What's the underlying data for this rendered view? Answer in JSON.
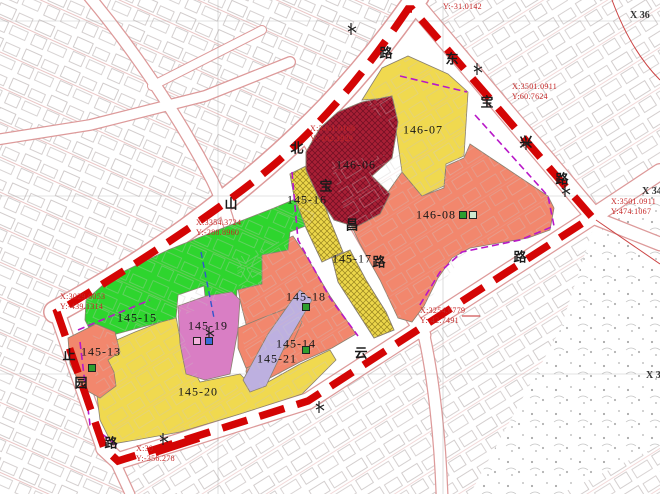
{
  "map": {
    "colors": {
      "green": "#2ed52e",
      "yellow": "#f0d94f",
      "salmon": "#f2876d",
      "crimson": "#a81f35",
      "pink": "#d97ec4",
      "lavender": "#bdb0e0",
      "hatch_base": "#ecd64a",
      "boundary_red": "#d40505",
      "purple_dash": "#b818c8",
      "blue_dash": "#3355cc",
      "coord_text": "#c62828",
      "icon_green": "#2f9e2f",
      "icon_pale": "#cfe8cf",
      "icon_blue": "#3a6cd8",
      "icon_pink": "#f2b3dd"
    },
    "parcels": [
      {
        "id": "145-15",
        "x": 137,
        "y": 318,
        "color": "green"
      },
      {
        "id": "145-13",
        "x": 101,
        "y": 352,
        "color": "salmon"
      },
      {
        "id": "145-19",
        "x": 208,
        "y": 326,
        "color": "pink"
      },
      {
        "id": "145-20",
        "x": 198,
        "y": 392,
        "color": "yellow"
      },
      {
        "id": "145-14",
        "x": 296,
        "y": 344,
        "color": "salmon"
      },
      {
        "id": "145-21",
        "x": 277,
        "y": 359,
        "color": "lavender"
      },
      {
        "id": "145-18",
        "x": 306,
        "y": 297,
        "color": "salmon"
      },
      {
        "id": "145-16",
        "x": 307,
        "y": 200,
        "color": "hatch_base"
      },
      {
        "id": "145-17",
        "x": 352,
        "y": 259,
        "color": "hatch_base"
      },
      {
        "id": "146-06",
        "x": 356,
        "y": 165,
        "color": "crimson"
      },
      {
        "id": "146-07",
        "x": 423,
        "y": 130,
        "color": "yellow"
      },
      {
        "id": "146-08",
        "x": 436,
        "y": 215,
        "color": "salmon"
      }
    ],
    "road_chars": [
      {
        "ch": "路",
        "x": 386,
        "y": 52
      },
      {
        "ch": "北",
        "x": 297,
        "y": 147
      },
      {
        "ch": "山",
        "x": 231,
        "y": 203
      },
      {
        "ch": "宝",
        "x": 326,
        "y": 185
      },
      {
        "ch": "昌",
        "x": 352,
        "y": 224
      },
      {
        "ch": "路",
        "x": 379,
        "y": 261
      },
      {
        "ch": "东",
        "x": 452,
        "y": 58
      },
      {
        "ch": "宝",
        "x": 487,
        "y": 101
      },
      {
        "ch": "兴",
        "x": 526,
        "y": 141
      },
      {
        "ch": "路",
        "x": 562,
        "y": 178
      },
      {
        "ch": "云",
        "x": 361,
        "y": 352
      },
      {
        "ch": "路",
        "x": 520,
        "y": 256
      },
      {
        "ch": "止",
        "x": 69,
        "y": 354
      },
      {
        "ch": "园",
        "x": 81,
        "y": 382
      },
      {
        "ch": "路",
        "x": 111,
        "y": 442
      }
    ],
    "coordinate_callouts": [
      {
        "line1": "Y:-31.0142",
        "line2": "",
        "x": 443,
        "y": 2
      },
      {
        "line1": "X:3461.0168",
        "line2": "Y:-162.1929",
        "x": 310,
        "y": 124
      },
      {
        "line1": "X:3354.3724",
        "line2": "Y:-288.8960",
        "x": 196,
        "y": 218
      },
      {
        "line1": "X:3029.0053",
        "line2": "Y:-439.1314",
        "x": 60,
        "y": 292
      },
      {
        "line1": "X:30",
        "line2": "Y:-356.278",
        "x": 136,
        "y": 444
      },
      {
        "line1": "X:3254.6779",
        "line2": "Y:-42.7491",
        "x": 420,
        "y": 306
      },
      {
        "line1": "X:3501.0911",
        "line2": "Y:60.7624",
        "x": 512,
        "y": 82
      },
      {
        "line1": "X:3501.0911",
        "line2": "Y:474.1067",
        "x": 611,
        "y": 197
      }
    ],
    "grid_labels": [
      {
        "text": "X 36",
        "x": 630,
        "y": 10
      },
      {
        "text": "X 34",
        "x": 642,
        "y": 186
      },
      {
        "text": "X 32",
        "x": 646,
        "y": 370
      }
    ],
    "marker_icons": [
      {
        "color": "icon_green",
        "x": 88,
        "y": 364
      },
      {
        "color": "icon_pink",
        "x": 193,
        "y": 337
      },
      {
        "color": "icon_blue",
        "x": 205,
        "y": 337
      },
      {
        "color": "icon_green",
        "x": 302,
        "y": 303
      },
      {
        "color": "icon_green",
        "x": 302,
        "y": 346
      },
      {
        "color": "icon_green",
        "x": 459,
        "y": 211
      },
      {
        "color": "icon_pale",
        "x": 469,
        "y": 211
      }
    ]
  }
}
